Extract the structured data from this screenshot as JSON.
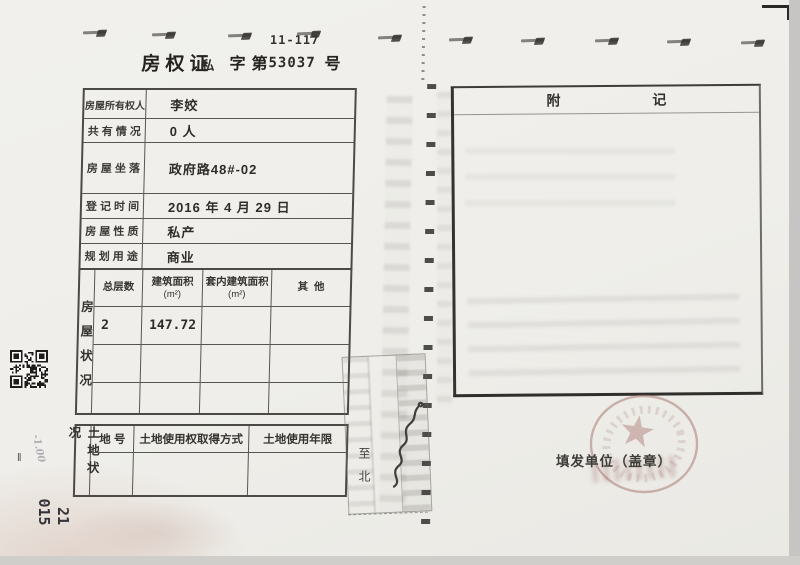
{
  "header": {
    "form_code": "11-117",
    "title": "房权证",
    "category": "私",
    "zi_di": "字第",
    "serial": "53037",
    "hao": "号"
  },
  "info": {
    "rows": [
      {
        "label": "房屋所有权人",
        "value": "李姣"
      },
      {
        "label": "共 有 情 况",
        "value": "0 人"
      },
      {
        "label": "房 屋 坐 落",
        "value": "政府路48#-02"
      },
      {
        "label": "登 记 时 间",
        "value": "2016 年 4 月 29 日"
      },
      {
        "label": "房 屋 性 质",
        "value": "私产"
      },
      {
        "label": "规 划 用 途",
        "value": "商业"
      }
    ]
  },
  "house": {
    "side_label": "房屋状况",
    "col_floors": "总层数",
    "col_area": "建筑面积",
    "col_area_unit": "(m²)",
    "col_inner": "套内建筑面积",
    "col_inner_unit": "(m²)",
    "col_other": "其  他",
    "floors": "2",
    "area": "147.72"
  },
  "land": {
    "side_label": "土地状况",
    "col_plot": "地 号",
    "col_method": "土地使用权取得方式",
    "col_term": "土地使用年限",
    "edge_note": "至北"
  },
  "notes": {
    "title_a": "附",
    "title_b": "记"
  },
  "issuer": {
    "label": "填发单位（盖章）"
  },
  "margin": {
    "num_a": "015",
    "num_b": "21",
    "tick": "‖",
    "pencil": "-1.00"
  }
}
